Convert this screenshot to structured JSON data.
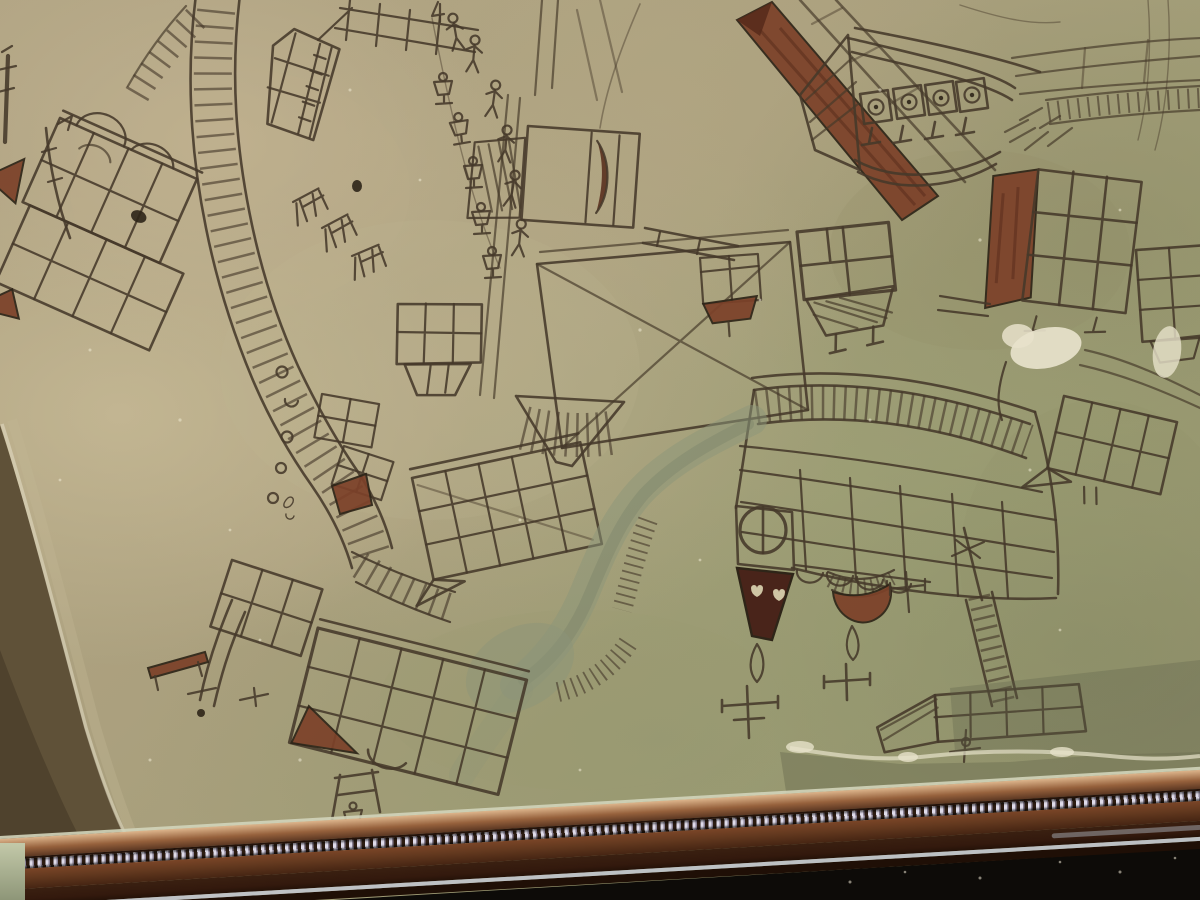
{
  "scene": {
    "type": "photograph",
    "description": "Close-up photograph of a framed naive folk-art drawing: a hand-drawn village map in brown ink on aged olive-tan parchment behind glass. Gridded timber-framed buildings are drawn at many different orientations, with ladder-like hatched roads, rows of tiny stick figures and goblet-shaped figures, an upside-down church with a round clock window, two dark spires ending in teardrop finials and ornate crosses, a grey-green river wash with red-brown hatched banks, red-ochre painted roofs, torn and damaged parchment edges over a dark brown mat, and the bottom rail of a wooden picture frame with a copper fillet and white bead molding running diagonally across the lower edge, with black shadow below the frame at lower right.",
    "no_visible_text": true
  },
  "palette": {
    "parchmentBase": "#aa9d7d",
    "parchmentLight": "#c4b795",
    "parchmentOlive": "#9aa077",
    "ink": "#46392a",
    "inkDark": "#2e2518",
    "maroon": "#7c4129",
    "maroonDark": "#562a1a",
    "river": "#8b9579",
    "riverDeep": "#6f7c64",
    "matBrown": "#5f5138",
    "matDark": "#423625",
    "tearWhite": "#e7e2cb",
    "frameLip": "#d2d4ba",
    "copperHi": "#ddb58c",
    "copper": "#96613c",
    "copperDark": "#5b3722",
    "beadLight": "#e0dcea",
    "beadDark": "#2c1c12",
    "woodBand": "#63391f",
    "woodDark": "#33190d",
    "woodDeep": "#1f0f06",
    "glassLine": "#c6cbd8",
    "greyStreak": "#a8adb5",
    "black": "#0d0b08"
  },
  "artwork": {
    "objects": [
      {
        "name": "building-topleft-complex",
        "kind": "cluster of tilted gridded buildings with brown gable triangles and poles"
      },
      {
        "name": "ladder-road-main",
        "kind": "wide hatched road curving from top edge to lower left"
      },
      {
        "name": "road-circles",
        "kind": "small circles drawn along road bend"
      },
      {
        "name": "small-house-top",
        "kind": "small tilted gridded house near top edge"
      },
      {
        "name": "trestle-benches",
        "kind": "row of small trestle shapes"
      },
      {
        "name": "villagers",
        "kind": "stick figures and goblet-shaped figures walking a lane"
      },
      {
        "name": "crescent-box",
        "kind": "rectangle containing dark crescent, hatched annex"
      },
      {
        "name": "red-roof-building",
        "kind": "long red-ochre painted roof with timber wall"
      },
      {
        "name": "arcade-building",
        "kind": "wide building with round-windowed arcade and columns"
      },
      {
        "name": "red-gable-building",
        "kind": "gridded building with red-ochre gable"
      },
      {
        "name": "x-square",
        "kind": "large square with X diagonals and hatched funnel"
      },
      {
        "name": "pentagon-house",
        "kind": "gridded pentagon house"
      },
      {
        "name": "barn-grid",
        "kind": "large tilted gridded barn"
      },
      {
        "name": "church-building",
        "kind": "large upside-down church with clock, spires, teardrop finials and crosses"
      },
      {
        "name": "river",
        "kind": "grey-green river wash with red-brown hatched bank"
      },
      {
        "name": "boat-building",
        "kind": "pointed gridded building with ladder mast and anchor"
      },
      {
        "name": "bottomleft-cluster",
        "kind": "gridded barn with brown gable, mast pole, table and goblet"
      },
      {
        "name": "hanging-building",
        "kind": "tilted gridded building with pointed corner, right edge"
      },
      {
        "name": "damage-patches",
        "kind": "white paper-loss patches"
      },
      {
        "name": "mat-wedge",
        "kind": "dark mat visible past torn parchment corner"
      },
      {
        "name": "frame-bottom-rail",
        "kind": "wood frame with copper fillet and bead molding"
      }
    ]
  },
  "frame": {
    "parts": [
      "pale-inner-lip",
      "copper-fillet",
      "bead-molding",
      "wood-band-upper",
      "wood-band-lower",
      "glass-reflection-line",
      "dark-tail",
      "black-shadow"
    ]
  }
}
